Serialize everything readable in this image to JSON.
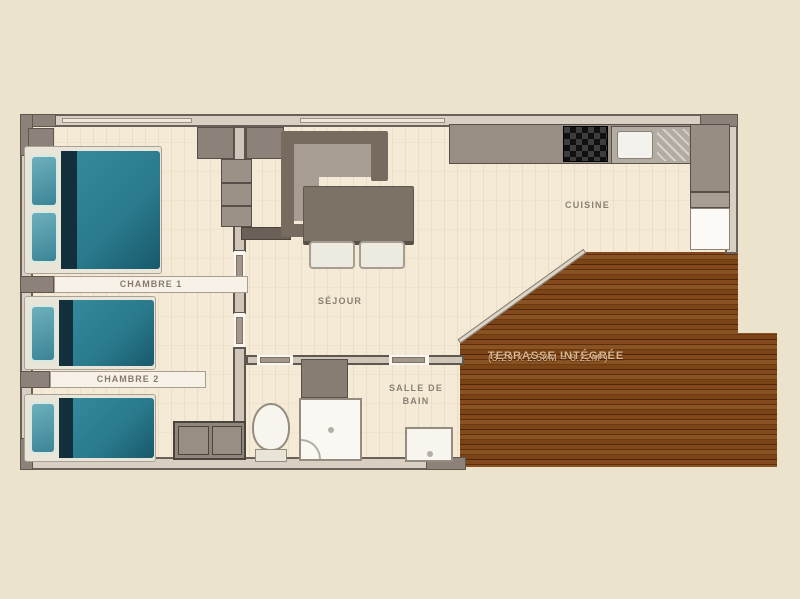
{
  "floorplan": {
    "rooms": {
      "chambre1": "CHAMBRE 1",
      "chambre2": "CHAMBRE 2",
      "sejour": "SÉJOUR",
      "cuisine": "CUISINE",
      "salle_de_bain_line1": "SALLE DE",
      "salle_de_bain_line2": "BAIN",
      "terrasse_line1": "TERRASSE INTÉGRÉE",
      "terrasse_line2": "(3.29 X 2.50M = 8.22M²)"
    },
    "colors": {
      "background": "#ece3cd",
      "floor": "#f4ead6",
      "wall_light": "#d9d0c3",
      "wall_gray": "#8d8279",
      "bed_teal": "#2a7a8d",
      "terrace_brown": "#7b4417",
      "terrace_text": "#dbb68e",
      "label_text": "#8a7f73"
    }
  }
}
